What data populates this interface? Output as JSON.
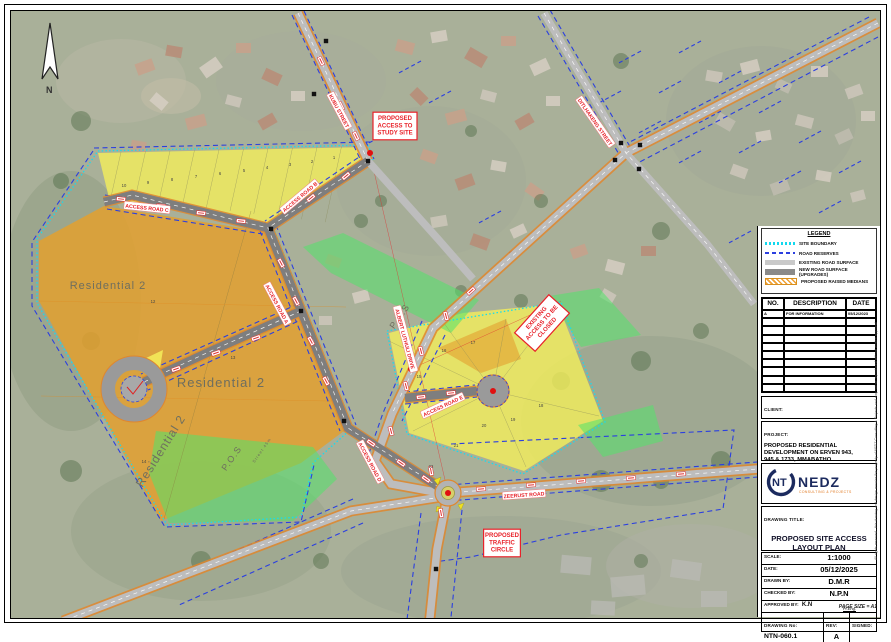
{
  "sheet": {
    "page_size_note": "PAGE SIZE = A1",
    "side_note": "All rights reserved - this drawing and design remains the property of NEDZ Consulting & Projects and may not be reproduced without written approval",
    "north": "N"
  },
  "legend": {
    "title": "LEGEND",
    "items": [
      {
        "swatch": "cyan-dotted",
        "label": "SITE BOUNDARY"
      },
      {
        "swatch": "blue-dashed",
        "label": "ROAD RESERVES"
      },
      {
        "swatch": "gray-light",
        "label": "EXISTING ROAD SURFACE"
      },
      {
        "swatch": "gray-dark",
        "label": "NEW ROAD SURFACE (UPGRADES)"
      },
      {
        "swatch": "orange-hatch",
        "label": "PROPOSED RAISED MEDIANS"
      }
    ]
  },
  "revisions": {
    "headers": [
      "NO.",
      "DESCRIPTION",
      "DATE"
    ],
    "rows": [
      [
        "A",
        "FOR INFORMATION",
        "05/12/2023"
      ]
    ],
    "empty_rows": 9
  },
  "panel": {
    "client_label": "CLIENT:",
    "project_label": "PROJECT:",
    "drawing_title_label": "DRAWING TITLE:"
  },
  "project": {
    "lines": [
      "PROPOSED RESIDENTIAL",
      "DEVELOPMENT ON ERVEN 943,",
      "945 & 1733, MMABATHO"
    ]
  },
  "logo": {
    "nt": "NT",
    "name": "NEDZ",
    "subtitle": "CONSULTING & PROJECTS"
  },
  "drawing": {
    "title_line1": "PROPOSED SITE ACCESS",
    "title_line2": "LAYOUT PLAN"
  },
  "fields": [
    {
      "label": "SCALE:",
      "value": "1:1000"
    },
    {
      "label": "DATE:",
      "value": "05/12/2025"
    },
    {
      "label": "DRAWN BY:",
      "value": "D.M.R"
    },
    {
      "label": "CHECKED BY:",
      "value": "N.P.N"
    },
    {
      "label": "APPROVED BY:",
      "value": "K.N",
      "extra": "Pr.Eng."
    }
  ],
  "drawing_no": {
    "label": "DRAWING No:",
    "value": "NTN-060.1",
    "rev_label": "REV:",
    "rev": "A",
    "signed_label": "SIGNED:",
    "signed_value": ""
  },
  "map": {
    "road_labels": [
      {
        "text": "KUBU STREET",
        "x": 338,
        "y": 110,
        "rot": 62
      },
      {
        "text": "ACCESS ROAD B",
        "x": 299,
        "y": 196,
        "rot": -40
      },
      {
        "text": "ACCESS ROAD C",
        "x": 146,
        "y": 207,
        "rot": 6
      },
      {
        "text": "ACCESS ROAD A",
        "x": 276,
        "y": 303,
        "rot": 62
      },
      {
        "text": "ACCESS ROAD D",
        "x": 369,
        "y": 461,
        "rot": 62
      },
      {
        "text": "ACCESS ROAD E",
        "x": 442,
        "y": 405,
        "rot": -25
      },
      {
        "text": "ALBERT LUTHULI DRIVE",
        "x": 404,
        "y": 338,
        "rot": 75
      },
      {
        "text": "ZEERUST ROAD",
        "x": 523,
        "y": 494,
        "rot": -4
      },
      {
        "text": "DITLHAKENG STREET",
        "x": 594,
        "y": 121,
        "rot": 55
      }
    ],
    "red_boxes": [
      {
        "lines": [
          "PROPOSED",
          "ACCESS TO",
          "STUDY SITE"
        ],
        "x": 394,
        "y": 125,
        "rot": 0
      },
      {
        "lines": [
          "EXISTING",
          "ACCESS TO BE",
          "CLOSED"
        ],
        "x": 541,
        "y": 322,
        "rot": -48
      },
      {
        "lines": [
          "PROPOSED",
          "TRAFFIC",
          "CIRCLE"
        ],
        "x": 501,
        "y": 542,
        "rot": 0
      }
    ],
    "area_labels": [
      {
        "text": "Residential 2",
        "x": 107,
        "y": 288,
        "rot": 0,
        "size": 11
      },
      {
        "text": "Residential 2",
        "x": 220,
        "y": 386,
        "rot": 0,
        "size": 13
      },
      {
        "text": "Residential 2",
        "x": 163,
        "y": 452,
        "rot": -58,
        "size": 12
      },
      {
        "text": "P.O.S",
        "x": 233,
        "y": 459,
        "rot": -55,
        "size": 9
      },
      {
        "text": "P.O.S",
        "x": 401,
        "y": 317,
        "rot": -55,
        "size": 9
      },
      {
        "text": "Street 45m",
        "x": 262,
        "y": 450,
        "rot": -55,
        "size": 4
      }
    ],
    "lot_numbers": [
      {
        "n": "10",
        "x": 123,
        "y": 186
      },
      {
        "n": "9",
        "x": 147,
        "y": 183
      },
      {
        "n": "8",
        "x": 171,
        "y": 180
      },
      {
        "n": "7",
        "x": 195,
        "y": 177
      },
      {
        "n": "6",
        "x": 219,
        "y": 174
      },
      {
        "n": "5",
        "x": 243,
        "y": 171
      },
      {
        "n": "4",
        "x": 266,
        "y": 168
      },
      {
        "n": "3",
        "x": 289,
        "y": 165
      },
      {
        "n": "2",
        "x": 311,
        "y": 162
      },
      {
        "n": "1",
        "x": 333,
        "y": 158
      },
      {
        "n": "12",
        "x": 152,
        "y": 302
      },
      {
        "n": "13",
        "x": 232,
        "y": 358
      },
      {
        "n": "14",
        "x": 143,
        "y": 462
      },
      {
        "n": "15",
        "x": 418,
        "y": 377
      },
      {
        "n": "16",
        "x": 443,
        "y": 351
      },
      {
        "n": "17",
        "x": 472,
        "y": 343
      },
      {
        "n": "18",
        "x": 540,
        "y": 406
      },
      {
        "n": "19",
        "x": 512,
        "y": 420
      },
      {
        "n": "20",
        "x": 483,
        "y": 426
      },
      {
        "n": "21",
        "x": 455,
        "y": 446
      },
      {
        "n": "22",
        "x": 430,
        "y": 467
      }
    ]
  }
}
